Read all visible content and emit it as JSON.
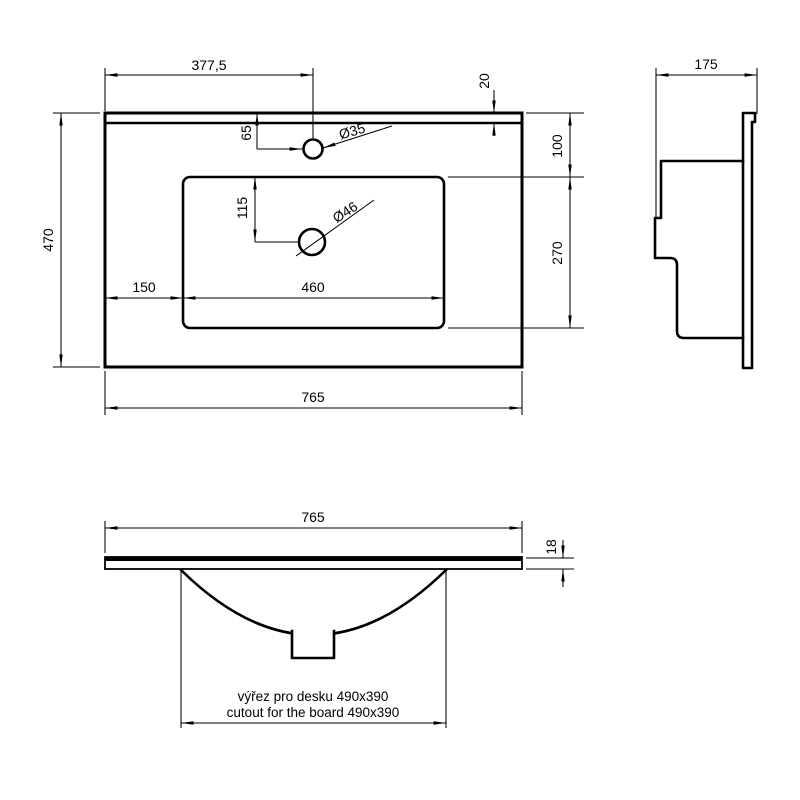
{
  "title": "washbasin technical drawing",
  "colors": {
    "line": "#000000",
    "background": "#ffffff"
  },
  "top_view": {
    "dim_faucet_x": "377,5",
    "dim_back_ledge": "20",
    "dim_faucet_y": "65",
    "dim_hole_faucet": "Ø35",
    "dim_hole_drain": "Ø46",
    "dim_bowl_top": "100",
    "dim_drain_y": "115",
    "dim_bowl_depth": "270",
    "dim_bowl_left": "150",
    "dim_bowl_width": "460",
    "dim_depth_total": "470",
    "dim_width_total": "765"
  },
  "side_view": {
    "dim_depth": "175"
  },
  "front_view": {
    "dim_width": "765",
    "dim_thickness": "18",
    "note_line1": "výřez pro desku 490x390",
    "note_line2": "cutout for the board 490x390"
  }
}
